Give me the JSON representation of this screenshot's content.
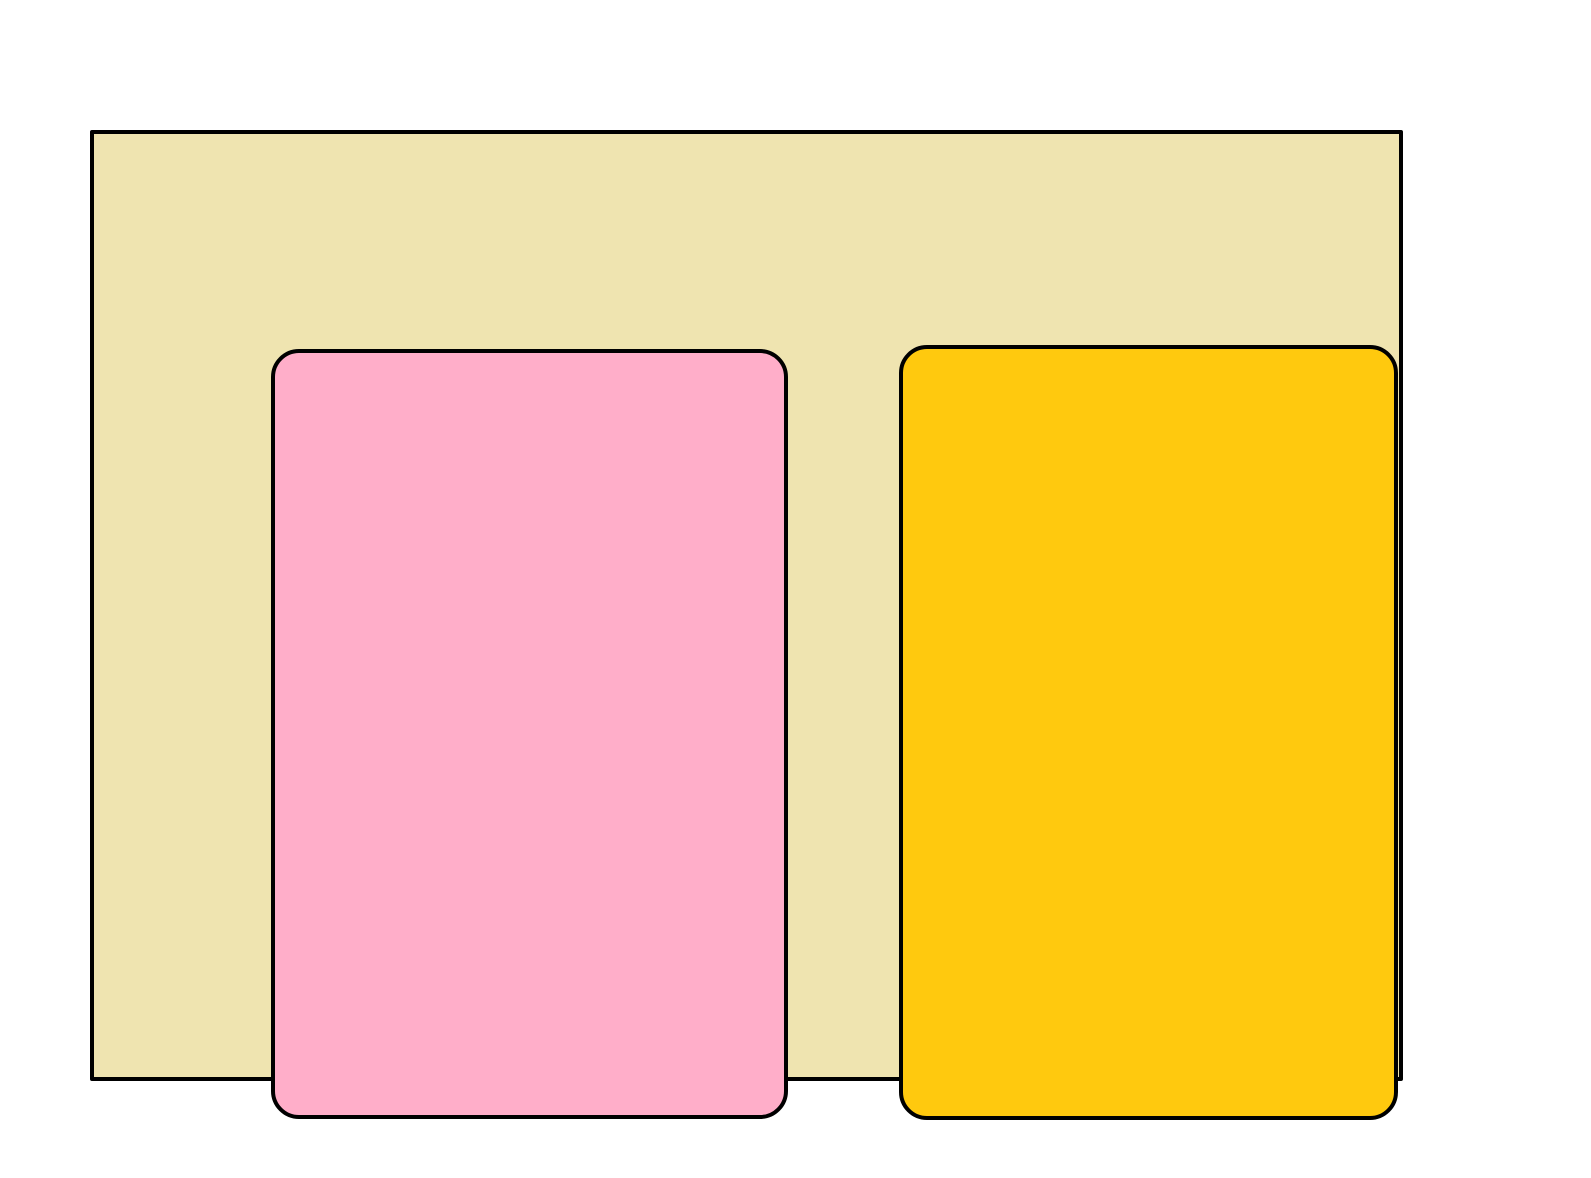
{
  "drawing": {
    "page_background_color": "#ffffff",
    "stroke_color": "#000000",
    "frame": {
      "shape": "rectangle",
      "fill": "#EFE4B0",
      "stroke": "#000000"
    },
    "left_rectangle": {
      "shape": "rounded-rectangle",
      "fill": "#FFAEC9",
      "stroke": "#000000"
    },
    "right_rectangle": {
      "shape": "rounded-rectangle",
      "fill": "#FFC90E",
      "stroke": "#000000"
    }
  }
}
